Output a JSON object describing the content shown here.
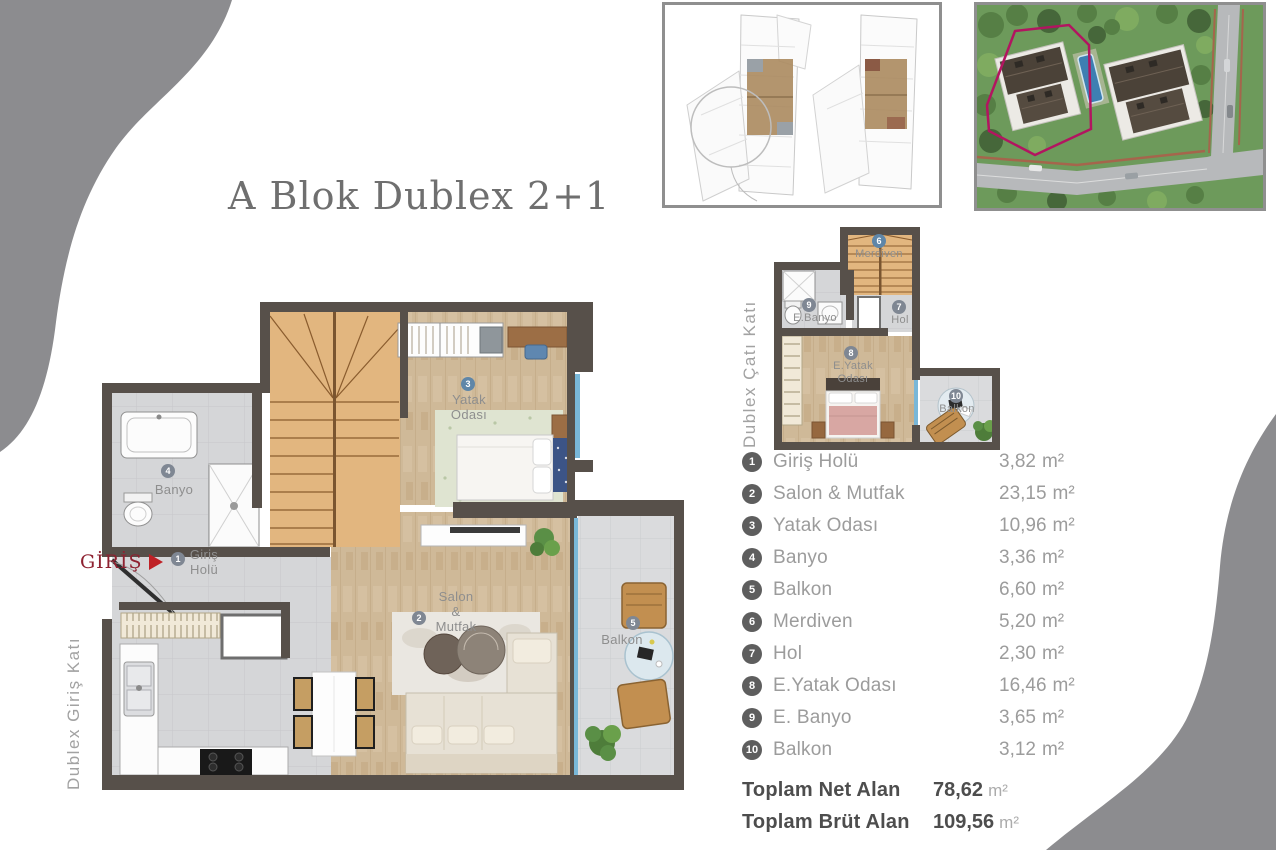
{
  "title": "A Blok Dublex 2+1",
  "entrance": {
    "label": "GİRİŞ"
  },
  "plans": {
    "ground": {
      "floor_label": "Dublex Giriş Katı",
      "rooms": [
        {
          "num": "1",
          "line1": "Giriş",
          "line2": "Holü"
        },
        {
          "num": "2",
          "line1": "Salon",
          "line2": "&",
          "line3": "Mutfak"
        },
        {
          "num": "3",
          "line1": "Yatak",
          "line2": "Odası"
        },
        {
          "num": "4",
          "line1": "Banyo"
        },
        {
          "num": "5",
          "line1": "Balkon"
        }
      ]
    },
    "roof": {
      "floor_label": "Dublex Çatı Katı",
      "rooms": [
        {
          "num": "6",
          "line1": "Merdiven"
        },
        {
          "num": "9",
          "line1": "E.Banyo"
        },
        {
          "num": "7",
          "line1": "Hol"
        },
        {
          "num": "8",
          "line1": "E.Yatak",
          "line2": "Odası"
        },
        {
          "num": "10",
          "line1": "Balkon"
        }
      ]
    }
  },
  "legend": {
    "unit": "m²",
    "items": [
      {
        "num": "1",
        "name": "Giriş Holü",
        "area": "3,82"
      },
      {
        "num": "2",
        "name": "Salon & Mutfak",
        "area": "23,15"
      },
      {
        "num": "3",
        "name": "Yatak Odası",
        "area": "10,96"
      },
      {
        "num": "4",
        "name": "Banyo",
        "area": "3,36"
      },
      {
        "num": "5",
        "name": "Balkon",
        "area": "6,60"
      },
      {
        "num": "6",
        "name": "Merdiven",
        "area": "5,20"
      },
      {
        "num": "7",
        "name": "Hol",
        "area": "2,30"
      },
      {
        "num": "8",
        "name": "E.Yatak Odası",
        "area": "16,46"
      },
      {
        "num": "9",
        "name": "E. Banyo",
        "area": "3,65"
      },
      {
        "num": "10",
        "name": "Balkon",
        "area": "3,12"
      }
    ],
    "totals": [
      {
        "label": "Toplam Net Alan",
        "value": "78,62"
      },
      {
        "label": "Toplam Brüt Alan",
        "value": "109,56"
      }
    ]
  },
  "colors": {
    "wall": "#57504a",
    "wood_floor": "#cfb998",
    "tile_floor": "#d4d5d7",
    "stair_wood": "#e0b376",
    "site_outline_magenta": "#b21560",
    "entrance_red": "#8e2130",
    "corner_blob_gray": "#8c8c8f",
    "glass_teal": "#79b7d8"
  }
}
